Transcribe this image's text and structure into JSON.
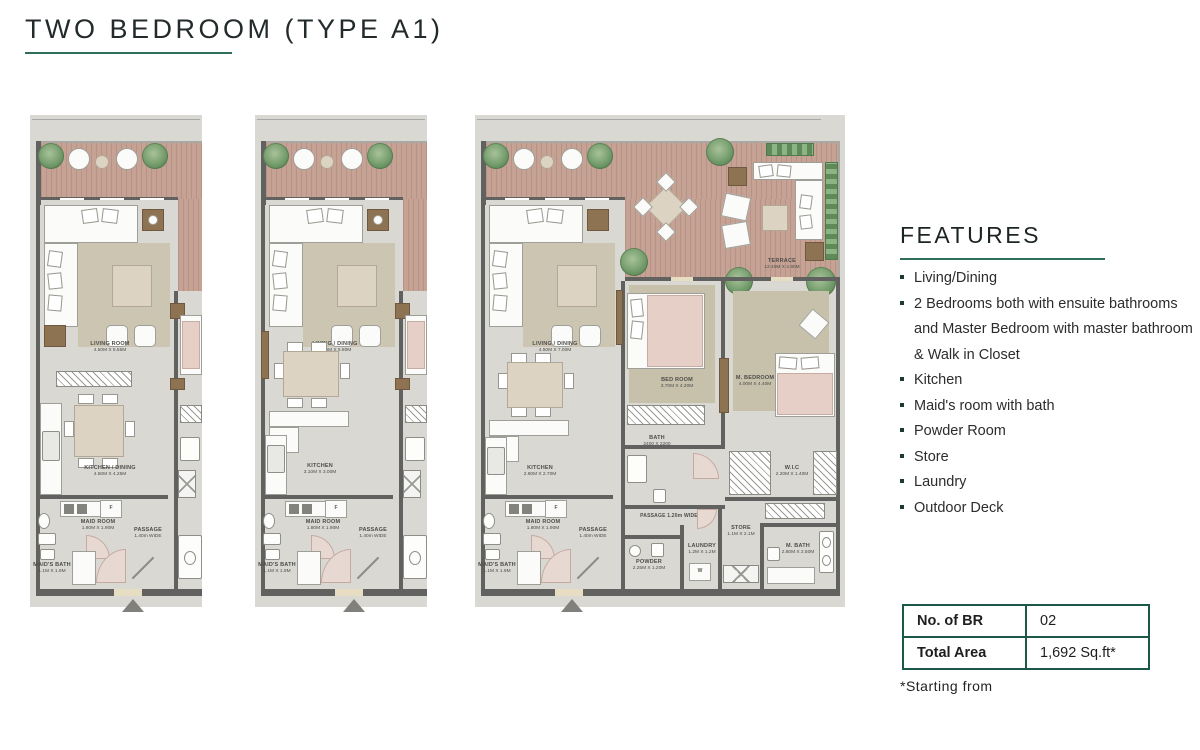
{
  "page": {
    "title": "TWO BEDROOM (TYPE A1)"
  },
  "features": {
    "heading": "FEATURES",
    "items": [
      "Living/Dining",
      "2 Bedrooms both with ensuite bathrooms and Master Bedroom with master bathroom & Walk in Closet",
      "Kitchen",
      "Maid's room with bath",
      "Powder Room",
      "Store",
      "Laundry",
      "Outdoor Deck"
    ]
  },
  "summary_table": {
    "rows": [
      {
        "label": "No. of BR",
        "value": "02"
      },
      {
        "label": "Total Area",
        "value": "1,692 Sq.ft*"
      }
    ],
    "footnote": "*Starting from"
  },
  "plans": [
    {
      "name": "plan-1",
      "labels": {
        "living": "LIVING ROOM",
        "living_dim": "4.50M X 5.55M",
        "kitchen": "KITCHEN / DINING",
        "kitchen_dim": "4.50M X 4.25M",
        "maid": "MAID ROOM",
        "maid_dim": "1.80M X 1.90M",
        "passage": "PASSAGE",
        "passage_dim": "1.40m WIDE",
        "maid_bath": "MAID'S BATH",
        "maid_bath_dim": "1.1M X 1.9M",
        "fridge": "F"
      }
    },
    {
      "name": "plan-2",
      "labels": {
        "living": "LIVING / DINING",
        "living_dim": "4.50M X 6.80M",
        "kitchen": "KITCHEN",
        "kitchen_dim": "3.10M X 3.00M",
        "maid": "MAID ROOM",
        "maid_dim": "1.80M X 1.90M",
        "passage": "PASSAGE",
        "passage_dim": "1.40m WIDE",
        "maid_bath": "MAID'S BATH",
        "maid_bath_dim": "1.1M X 1.9M",
        "fridge": "F"
      }
    },
    {
      "name": "plan-3",
      "labels": {
        "living": "LIVING / DINING",
        "living_dim": "4.50M X 7.00M",
        "terrace": "TERRACE",
        "terrace_dim": "12.40M X 4.90M",
        "bedroom": "BED ROOM",
        "bedroom_dim": "3.70M X 4.20M",
        "m_bedroom": "M. BEDROOM",
        "m_bedroom_dim": "4.00M X 4.40M",
        "bath": "BATH",
        "bath_dim": "2400 X 2200",
        "wic": "W.I.C",
        "wic_dim": "2.20M X 1.40M",
        "kitchen": "KITCHEN",
        "kitchen_dim": "2.90M X 2.70M",
        "maid": "MAID ROOM",
        "maid_dim": "1.80M X 1.90M",
        "passage": "PASSAGE",
        "passage_dim": "1.40m WIDE",
        "passage2": "PASSAGE 1.20m WIDE",
        "store": "STORE",
        "store_dim": "1.1M X 2.1M",
        "laundry": "LAUNDRY",
        "laundry_dim": "1.2M X 1.2M",
        "powder": "POWDER",
        "powder_dim": "2.25M X 1.20M",
        "m_bath": "M. BATH",
        "m_bath_dim": "2.80M X 2.50M",
        "maid_bath": "MAID'S BATH",
        "maid_bath_dim": "1.1M X 1.9M",
        "fridge": "F",
        "washer": "W"
      }
    }
  ],
  "colors": {
    "accent_teal": "#2e6e5a",
    "table_border": "#1c584a",
    "wall": "#61615f",
    "floor": "#d9d8d3",
    "terrace_wood": "#c6a295"
  }
}
